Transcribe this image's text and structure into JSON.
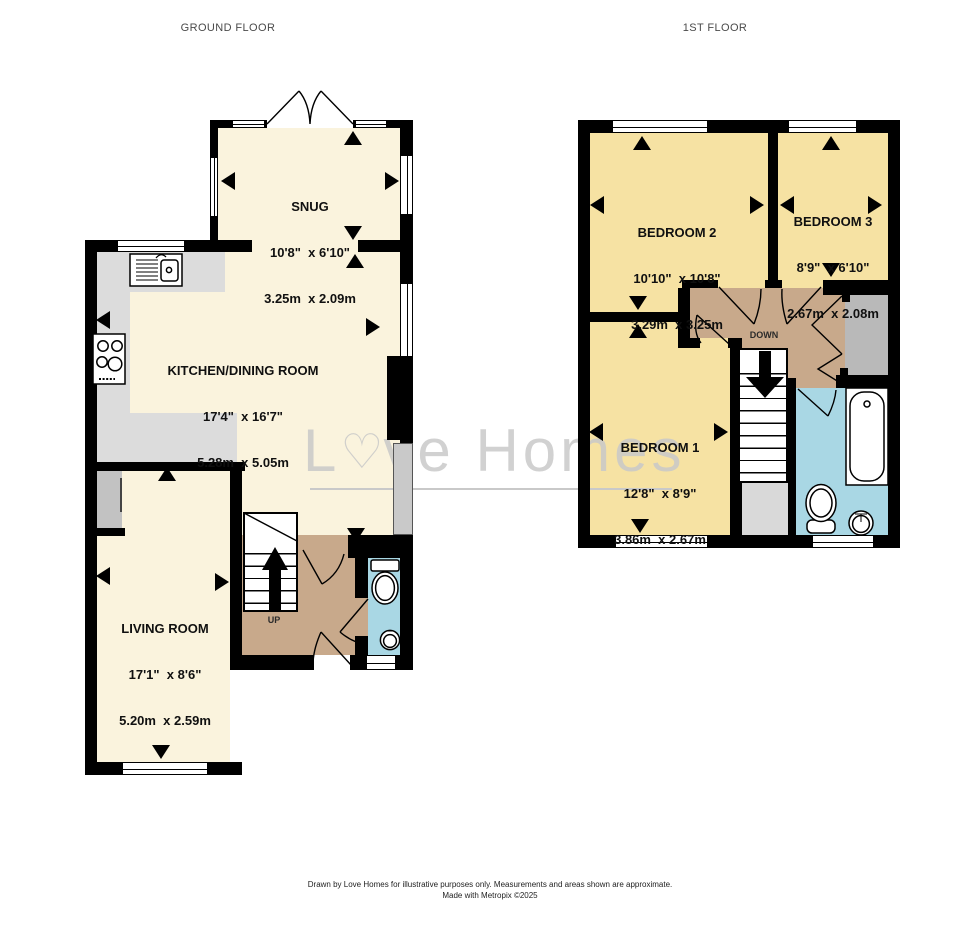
{
  "header": {
    "ground_floor_title": "GROUND FLOOR",
    "first_floor_title": "1ST FLOOR"
  },
  "watermark": {
    "prefix": "L",
    "heart": "♡",
    "suffix": "ve Homes"
  },
  "rooms": {
    "snug": {
      "name": "SNUG",
      "imperial": "10'8\"  x 6'10\"",
      "metric": "3.25m  x 2.09m"
    },
    "kitchen": {
      "name": "KITCHEN/DINING ROOM",
      "imperial": "17'4\"  x 16'7\"",
      "metric": "5.28m  x 5.05m"
    },
    "living": {
      "name": "LIVING ROOM",
      "imperial": "17'1\"  x 8'6\"",
      "metric": "5.20m  x 2.59m"
    },
    "bedroom2": {
      "name": "BEDROOM 2",
      "imperial": "10'10\"  x 10'8\"",
      "metric": "3.29m  x 3.25m"
    },
    "bedroom3": {
      "name": "BEDROOM 3",
      "imperial": "8'9\"  x 6'10\"",
      "metric": "2.67m  x 2.08m"
    },
    "bedroom1": {
      "name": "BEDROOM 1",
      "imperial": "12'8\"  x 8'9\"",
      "metric": "3.86m  x 2.67m"
    }
  },
  "stairs": {
    "up_label": "UP",
    "down_label": "DOWN"
  },
  "footer": {
    "line1": "Drawn by Love Homes for illustrative purposes only. Measurements and areas shown are approximate.",
    "line2": "Made with Metropix ©2025"
  },
  "colors": {
    "room-cream": "#faf3dd",
    "room-yellow": "#f6e2a3",
    "hall-tan": "#c8a98b",
    "bath-blue": "#a9d7e4",
    "counter-gray": "#dcdcdc",
    "cupboard-gray": "#b9b9b9",
    "void-gray": "#d9d9d9",
    "wall-black": "#000000",
    "watermark-gray": "#c9c9c9"
  }
}
